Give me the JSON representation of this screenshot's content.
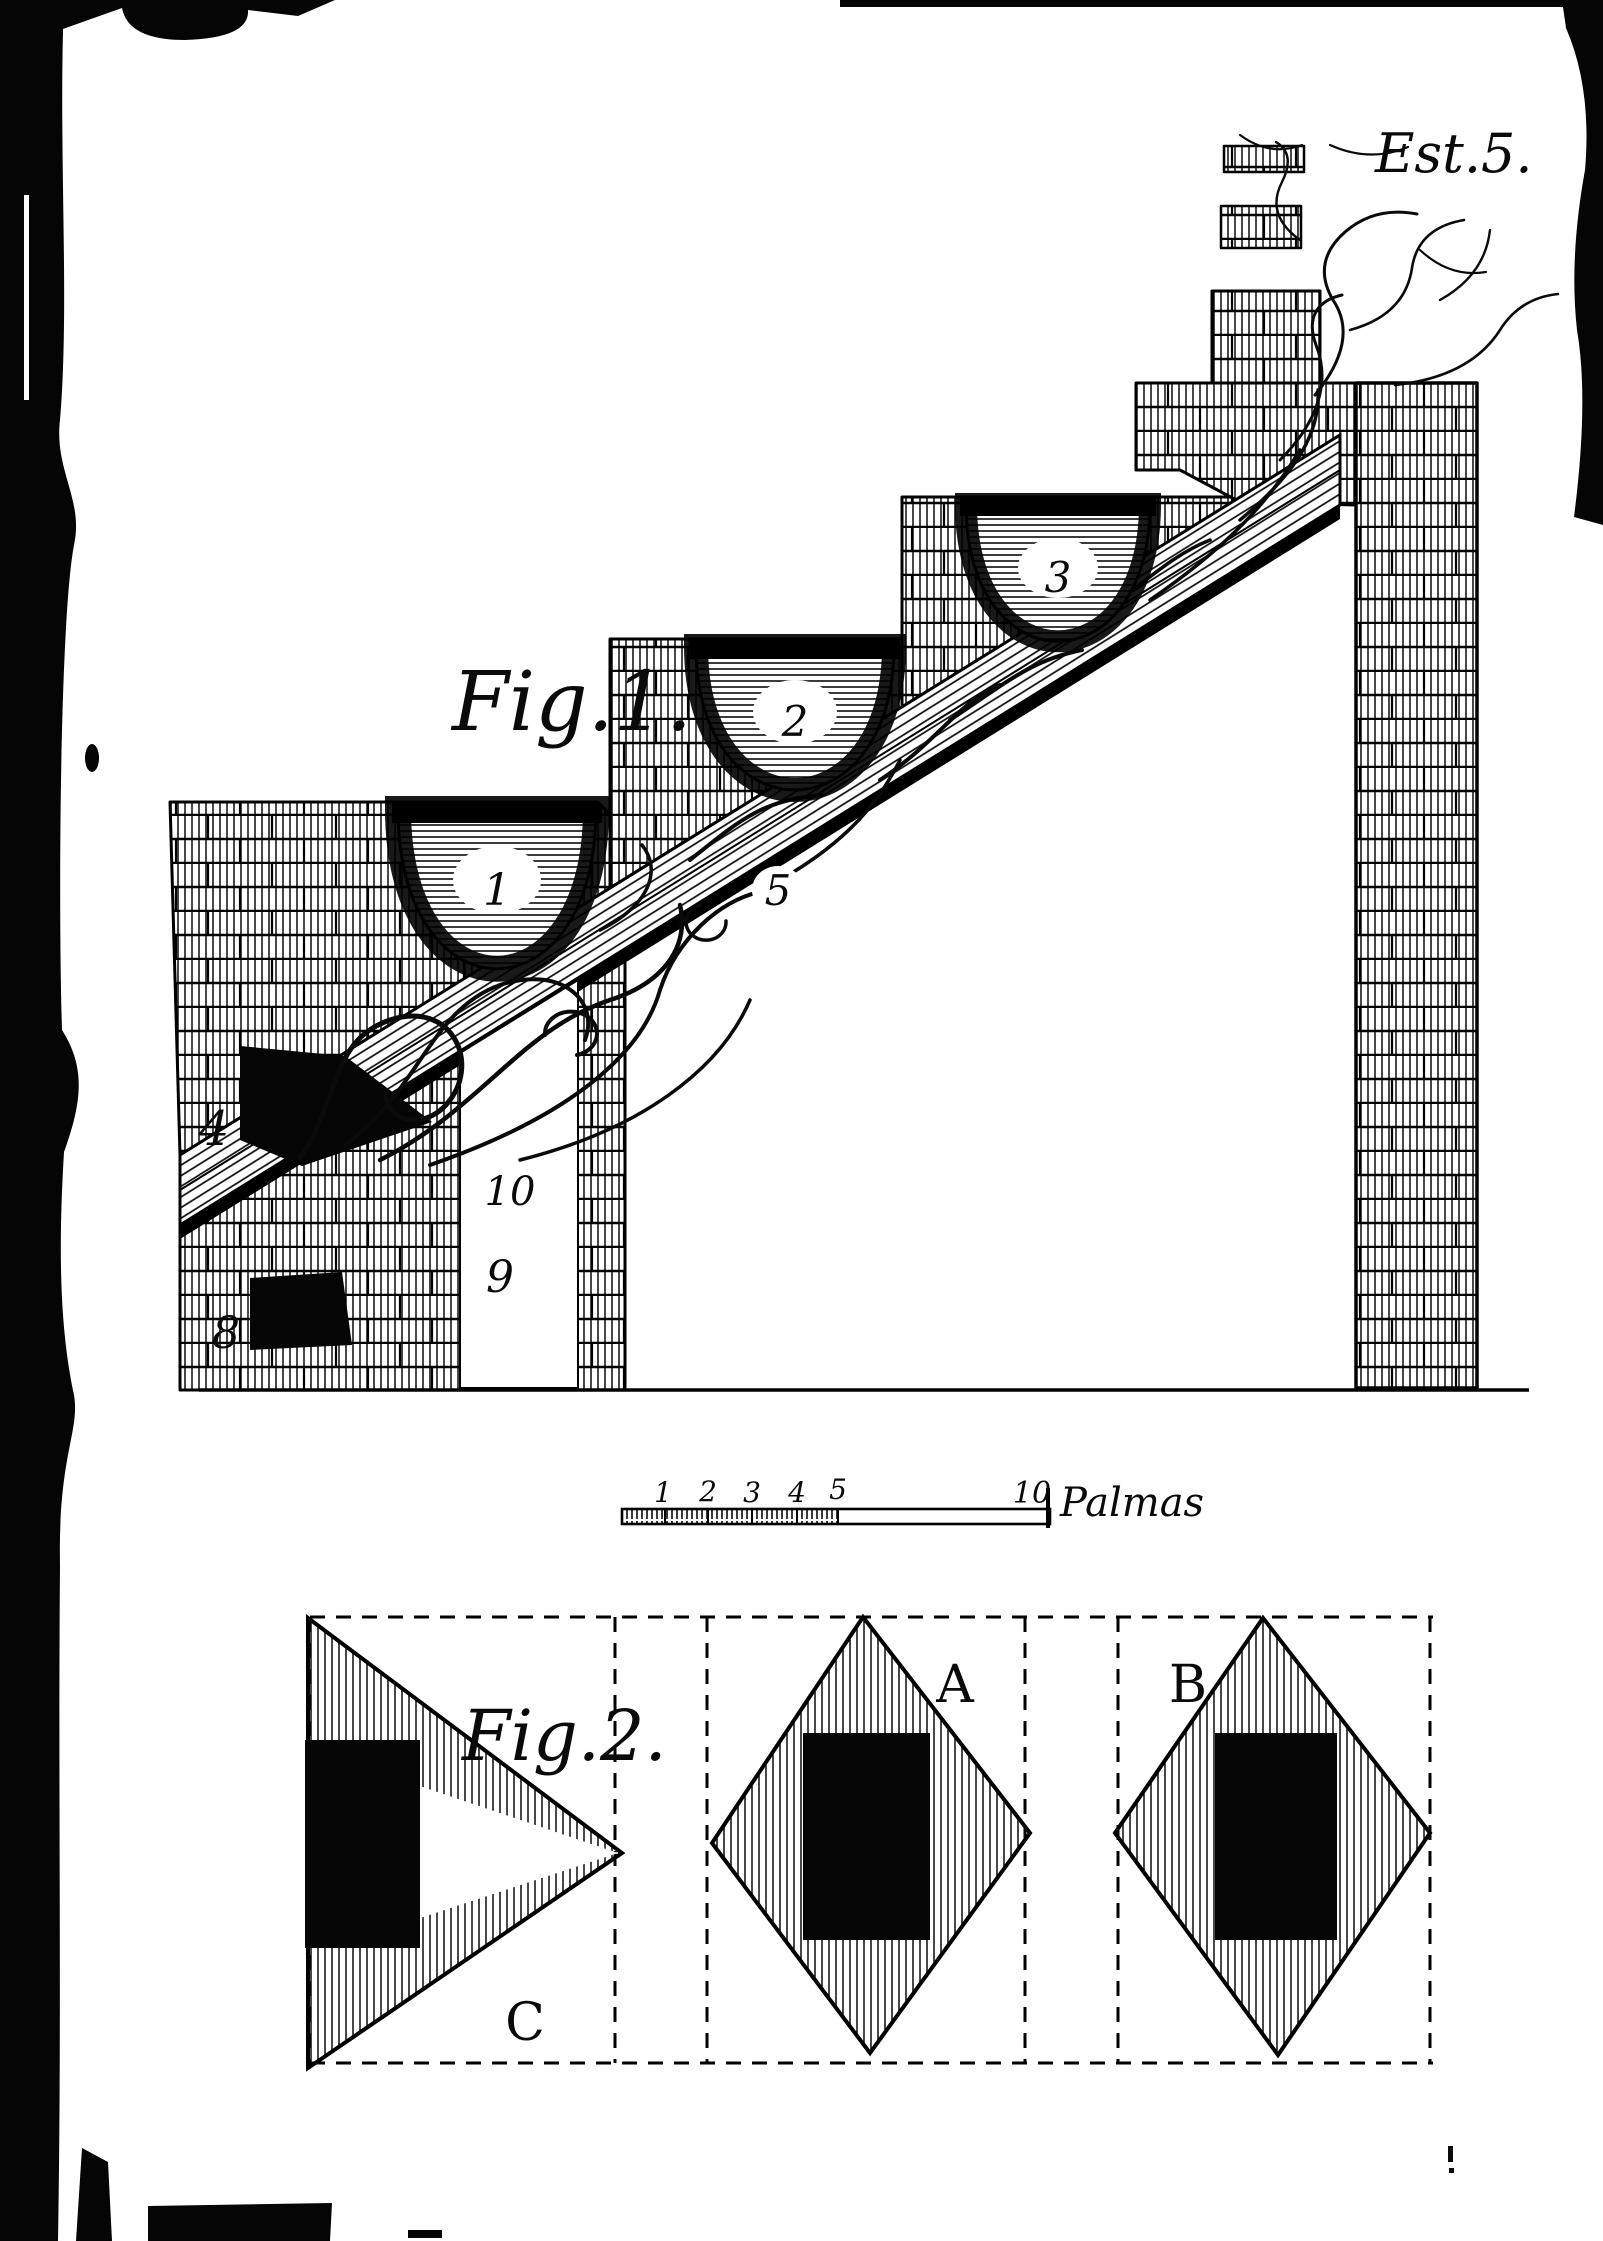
{
  "page": {
    "plate_label": "Est.5.",
    "paper_color": "#ffffff",
    "ink_color": "#0a0a0a"
  },
  "figure1": {
    "label": "Fig.1.",
    "cauldrons": [
      {
        "label": "1"
      },
      {
        "label": "2"
      },
      {
        "label": "3"
      }
    ],
    "flame_label": "5",
    "flue_label": "4",
    "vents": {
      "upper": "10",
      "middle": "9",
      "lower": "8"
    }
  },
  "scale_bar": {
    "ticks": [
      "1",
      "2",
      "3",
      "4",
      "5"
    ],
    "end_label": "10",
    "unit": "Palmas"
  },
  "figure2": {
    "label": "Fig.2.",
    "panels": {
      "left": "C",
      "middle": "A",
      "right": "B"
    }
  }
}
